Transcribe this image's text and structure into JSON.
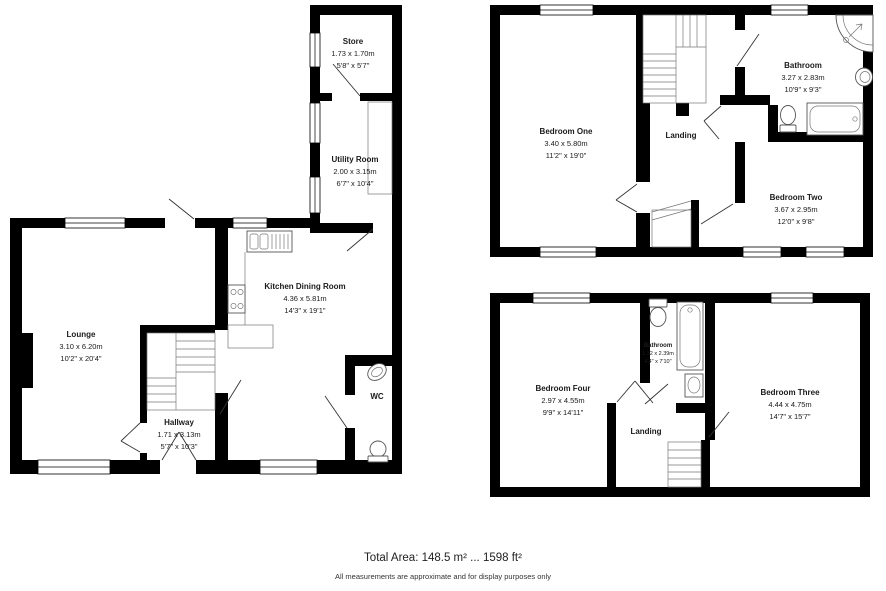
{
  "floors": {
    "ground": {
      "rooms": {
        "store": {
          "name": "Store",
          "metric": "1.73 x 1.70m",
          "imperial": "5'8\" x 5'7\""
        },
        "utility": {
          "name": "Utility Room",
          "metric": "2.00 x 3.15m",
          "imperial": "6'7\" x 10'4\""
        },
        "kitchen": {
          "name": "Kitchen Dining Room",
          "metric": "4.36 x 5.81m",
          "imperial": "14'3\" x 19'1\""
        },
        "lounge": {
          "name": "Lounge",
          "metric": "3.10 x 6.20m",
          "imperial": "10'2\" x 20'4\""
        },
        "hallway": {
          "name": "Hallway",
          "metric": "1.71 x 3.13m",
          "imperial": "5'7\" x 10'3\""
        },
        "wc": {
          "name": "WC"
        }
      }
    },
    "first": {
      "rooms": {
        "bedroom_one": {
          "name": "Bedroom One",
          "metric": "3.40 x 5.80m",
          "imperial": "11'2\" x 19'0\""
        },
        "landing": {
          "name": "Landing"
        },
        "bathroom": {
          "name": "Bathroom",
          "metric": "3.27 x 2.83m",
          "imperial": "10'9\" x 9'3\""
        },
        "bedroom_two": {
          "name": "Bedroom Two",
          "metric": "3.67 x 2.95m",
          "imperial": "12'0\" x 9'8\""
        }
      }
    },
    "second": {
      "rooms": {
        "bedroom_four": {
          "name": "Bedroom Four",
          "metric": "2.97 x 4.55m",
          "imperial": "9'9\" x 14'11\""
        },
        "bathroom": {
          "name": "Bathroom",
          "metric": "1.32 x 2.39m",
          "imperial": "4'4\" x 7'10\""
        },
        "landing": {
          "name": "Landing"
        },
        "bedroom_three": {
          "name": "Bedroom Three",
          "metric": "4.44 x 4.75m",
          "imperial": "14'7\" x 15'7\""
        }
      }
    }
  },
  "footer": {
    "total_area": "Total Area: 148.5 m² ... 1598 ft²",
    "disclaimer": "All measurements are approximate and for display purposes only"
  },
  "colors": {
    "wall": "#000000",
    "text": "#1a1a1a",
    "fixture_line": "#555555"
  }
}
